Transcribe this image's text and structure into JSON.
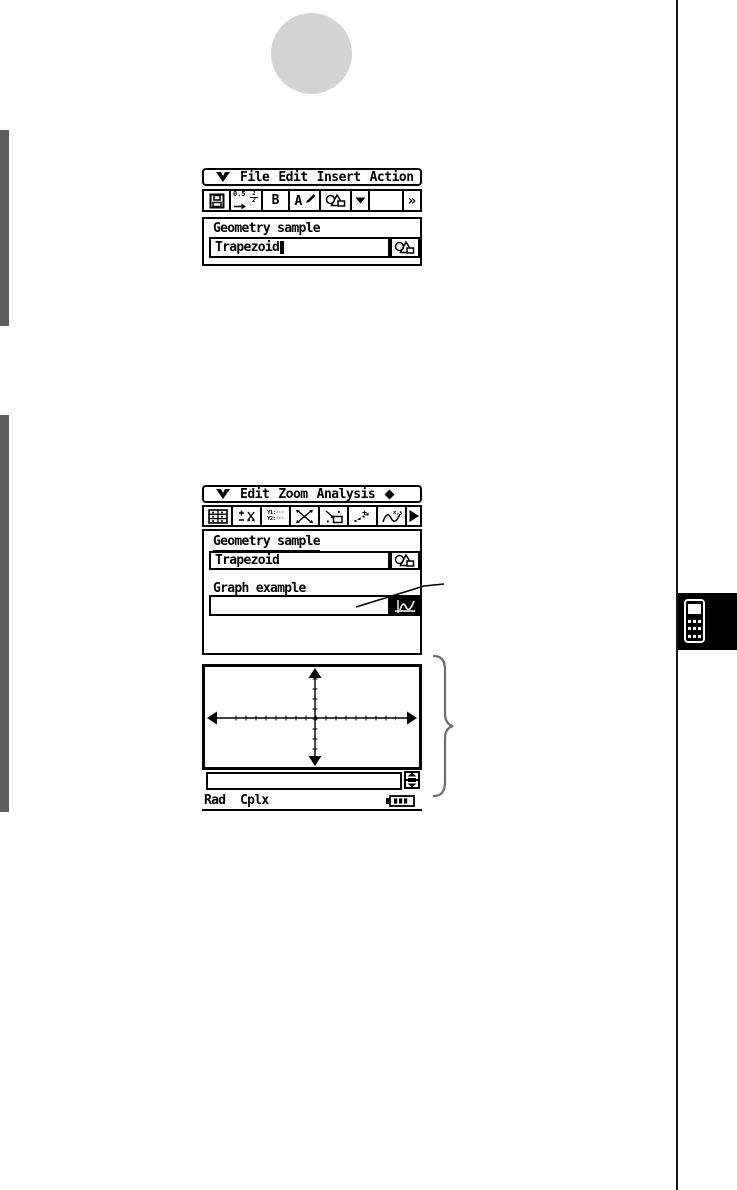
{
  "colors": {
    "margin_bar": "#5e5e5e",
    "circle": "#d4d4d4",
    "screen_border": "#000000",
    "brace": "#6e6e6e"
  },
  "icons": {
    "menu_logo": "classpad-logo",
    "save": "floppy-disk",
    "dropdown": "triangle-down",
    "more": "double-chevron-right",
    "geometry": "circle-triangle-square",
    "graph": "graph-curve-inverted",
    "next": "triangle-right",
    "diamond": "diamond",
    "battery": "battery-level",
    "spinner_up": "arrow-up",
    "spinner_down": "arrow-down",
    "chapter": "calculator"
  },
  "screen1": {
    "menu": {
      "items": [
        "File",
        "Edit",
        "Insert",
        "Action"
      ]
    },
    "toolbar": {
      "frac_top": "0.5",
      "frac_num": "1",
      "frac_den": "2",
      "bold": "B",
      "font": "A",
      "more": "»"
    },
    "body": {
      "title": "Geometry sample",
      "name_value": "Trapezoid"
    }
  },
  "screen2": {
    "menu": {
      "items": [
        "Edit",
        "Zoom",
        "Analysis"
      ]
    },
    "toolbar": {
      "y1": "Y1:···",
      "y2": "Y2:···",
      "xy": "x,y"
    },
    "body": {
      "title": "Geometry sample",
      "name_value": "Trapezoid",
      "graph_label": "Graph example",
      "graph_value": ""
    },
    "status": {
      "angle": "Rad",
      "complex": "Cplx"
    }
  }
}
